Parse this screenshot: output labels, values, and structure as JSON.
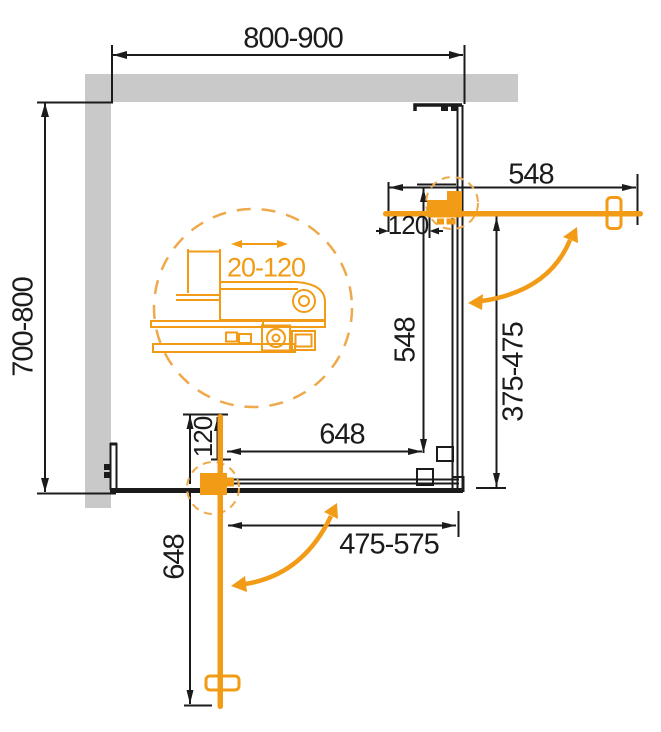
{
  "diagram": {
    "title": "corner shower enclosure plan view with two sliding doors",
    "dimensions": {
      "top_width": "800-900",
      "left_depth": "700-800",
      "top_door_length": "548",
      "right_panel_length": "548",
      "right_opening": "375-475",
      "bottom_panel_length": "648",
      "bottom_door_length": "648",
      "bottom_opening": "475-575",
      "top_wall_offset": "120",
      "bottom_wall_offset": "120",
      "detail_adjustment_range": "20-120"
    },
    "colors": {
      "accent_orange": "#F29B17",
      "dashed_orange": "#EEA94C",
      "wall_gray": "#C9C9C9",
      "line_black": "#1B1B1B",
      "background": "#FFFFFF"
    }
  }
}
